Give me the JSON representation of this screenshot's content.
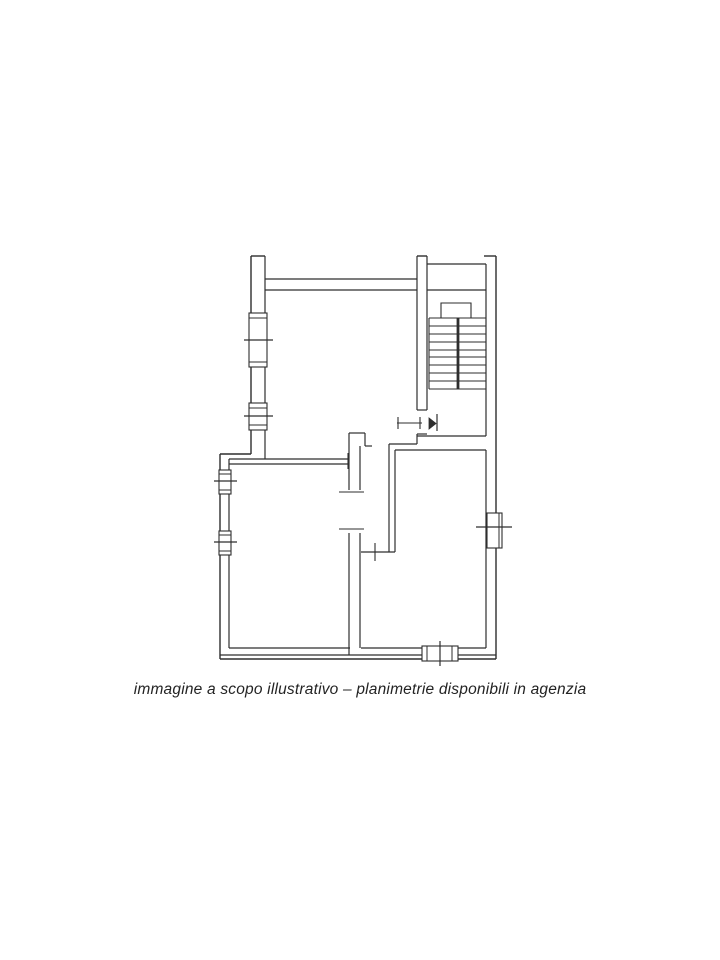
{
  "page": {
    "background": "#ffffff",
    "line_color": "#2e2e2e"
  },
  "caption": {
    "text": "immagine a scopo illustrativo – planimetrie disponibili in agenzia"
  },
  "floor_plan": {
    "description": "black-and-white apartment floor plan scan with staircase, entrance door, three rooms, corridor and windows",
    "viewbox": [
      0,
      0,
      720,
      960
    ],
    "wall_lines": [
      [
        251,
        256,
        251,
        454,
        1.4
      ],
      [
        251,
        454,
        220,
        454,
        1.4
      ],
      [
        220,
        454,
        220,
        659,
        1.4
      ],
      [
        220,
        659,
        496,
        659,
        1.4
      ],
      [
        496,
        256,
        496,
        659,
        1.4
      ],
      [
        484,
        256,
        496,
        256,
        1.4
      ],
      [
        251,
        256,
        265,
        256,
        1.4
      ],
      [
        417,
        256,
        427,
        256,
        1.4
      ],
      [
        265,
        256,
        265,
        459,
        1.2
      ],
      [
        265,
        279,
        417,
        279,
        1.2
      ],
      [
        265,
        290,
        417,
        290,
        1.2
      ],
      [
        417,
        256,
        417,
        410,
        1.2
      ],
      [
        427,
        256,
        427,
        410,
        1.2
      ],
      [
        417,
        410,
        427,
        410,
        1.2
      ],
      [
        417,
        434,
        427,
        434,
        1.2
      ],
      [
        427,
        264,
        486,
        264,
        1.2
      ],
      [
        427,
        290,
        486,
        290,
        1.2
      ],
      [
        486,
        264,
        486,
        436,
        1.2
      ],
      [
        417,
        436,
        486,
        436,
        1.2
      ],
      [
        389,
        444,
        417,
        444,
        1.2
      ],
      [
        395,
        450,
        486,
        450,
        1.2
      ],
      [
        417,
        434,
        417,
        444,
        1.2
      ],
      [
        389,
        444,
        389,
        552,
        1.2
      ],
      [
        395,
        450,
        395,
        552,
        1.2
      ],
      [
        361,
        552,
        395,
        552,
        1.2
      ],
      [
        229,
        459,
        348,
        459,
        1.2
      ],
      [
        229,
        464,
        348,
        464,
        1.2
      ],
      [
        229,
        459,
        229,
        648,
        1.2
      ],
      [
        229,
        648,
        350,
        648,
        1.2
      ],
      [
        361,
        648,
        486,
        648,
        1.2
      ],
      [
        220,
        655,
        496,
        655,
        1.2
      ],
      [
        486,
        450,
        486,
        648,
        1.2
      ],
      [
        349,
        433,
        365,
        433,
        1.2
      ],
      [
        365,
        433,
        365,
        446,
        1.2
      ],
      [
        365,
        446,
        372,
        446,
        1.2
      ],
      [
        349,
        433,
        349,
        490,
        1.2
      ],
      [
        360,
        446,
        360,
        490,
        1.2
      ],
      [
        349,
        533,
        349,
        655,
        1.2
      ],
      [
        360,
        533,
        360,
        648,
        1.2
      ],
      [
        339,
        492,
        364,
        492,
        1.1
      ],
      [
        339,
        529,
        364,
        529,
        1.1
      ],
      [
        348,
        453,
        348,
        469,
        1.1
      ],
      [
        375,
        543,
        375,
        561,
        1.1
      ],
      [
        397,
        423,
        422,
        423,
        1.1
      ],
      [
        398,
        417,
        398,
        429,
        1.1
      ],
      [
        420,
        417,
        420,
        429,
        1.1
      ],
      [
        429,
        318,
        429,
        389,
        1.1
      ]
    ],
    "windows": [
      {
        "name": "window-upper-left-large",
        "rect": [
          249,
          313,
          18,
          54
        ],
        "lines": [
          [
            249,
            318,
            267,
            318
          ],
          [
            249,
            362,
            267,
            362
          ]
        ],
        "tick": [
          244,
          340,
          273,
          340
        ]
      },
      {
        "name": "window-upper-left-small",
        "rect": [
          249,
          403,
          18,
          27
        ],
        "lines": [
          [
            249,
            408,
            267,
            408
          ],
          [
            249,
            425,
            267,
            425
          ]
        ],
        "tick": [
          244,
          416,
          273,
          416
        ]
      },
      {
        "name": "window-lower-left-1",
        "rect": [
          219,
          470,
          12,
          24
        ],
        "lines": [
          [
            219,
            474,
            231,
            474
          ],
          [
            219,
            490,
            231,
            490
          ]
        ],
        "tick": [
          214,
          481,
          237,
          481
        ]
      },
      {
        "name": "window-lower-left-2",
        "rect": [
          219,
          531,
          12,
          24
        ],
        "lines": [
          [
            219,
            535,
            231,
            535
          ],
          [
            219,
            551,
            231,
            551
          ]
        ],
        "tick": [
          214,
          542,
          237,
          542
        ]
      },
      {
        "name": "window-right",
        "rect": [
          487,
          513,
          15,
          35
        ],
        "lines": [
          [
            499,
            513,
            499,
            548
          ]
        ],
        "tick": [
          476,
          527,
          512,
          527
        ]
      },
      {
        "name": "window-bottom",
        "rect": [
          422,
          646,
          36,
          15
        ],
        "lines": [
          [
            427,
            646,
            427,
            661
          ],
          [
            452,
            646,
            452,
            661
          ]
        ],
        "tick": [
          440,
          641,
          440,
          666
        ]
      }
    ],
    "staircase": {
      "tread_x1": 429,
      "tread_x2": 486,
      "treads_y": [
        318,
        326,
        334,
        342,
        350,
        357,
        365,
        373,
        381,
        389
      ],
      "stringer": [
        458,
        318,
        458,
        389,
        2.8
      ],
      "turn_outline": [
        [
          441,
          318
        ],
        [
          441,
          303
        ],
        [
          471,
          303
        ],
        [
          471,
          318
        ]
      ]
    },
    "entrance_door": {
      "pennant_triangle": [
        [
          429,
          418
        ],
        [
          429,
          429
        ],
        [
          436,
          423.5
        ]
      ],
      "pennant_line": [
        437,
        414,
        437,
        431
      ]
    }
  }
}
